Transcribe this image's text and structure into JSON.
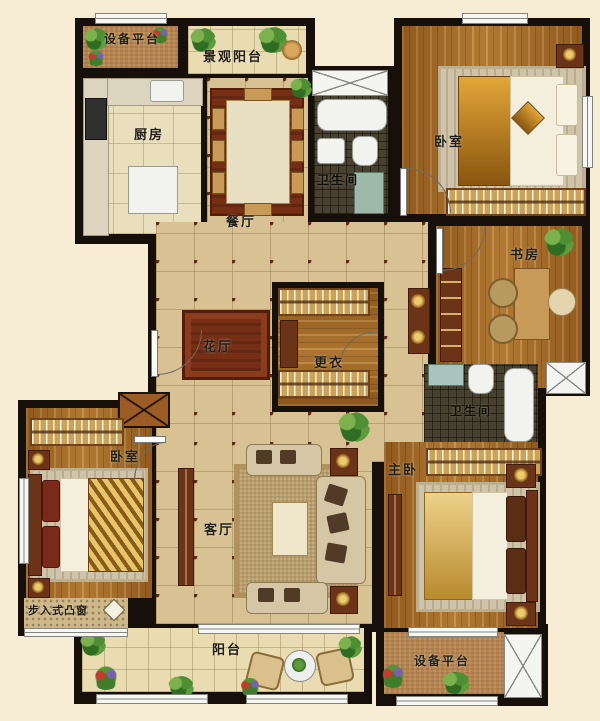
{
  "plan": {
    "type": "residential apartment floor plan",
    "rooms": {
      "equipment_platform_top": "设备平台",
      "scenic_balcony": "景观阳台",
      "kitchen": "厨房",
      "dining_room": "餐厅",
      "bathroom_top": "卫生间",
      "bedroom_top_right": "卧室",
      "study": "书房",
      "flower_hall": "花厅",
      "dressing_room": "更衣",
      "bathroom_right": "卫生间",
      "bedroom_left": "卧室",
      "master_bedroom": "主卧",
      "living_room": "客厅",
      "walk_in_bay_window": "步入式凸窗",
      "balcony_bottom": "阳台",
      "equipment_platform_bottom": "设备平台"
    },
    "colors": {
      "page_background": "#f7edd5",
      "wall": "#17100a",
      "wood_floor": "#a06826",
      "hall_tile": "#d8c294",
      "mosaic_tile": "#49412f",
      "flower_hall_rug": "#762f15",
      "greenery": "#3f7d28"
    }
  }
}
